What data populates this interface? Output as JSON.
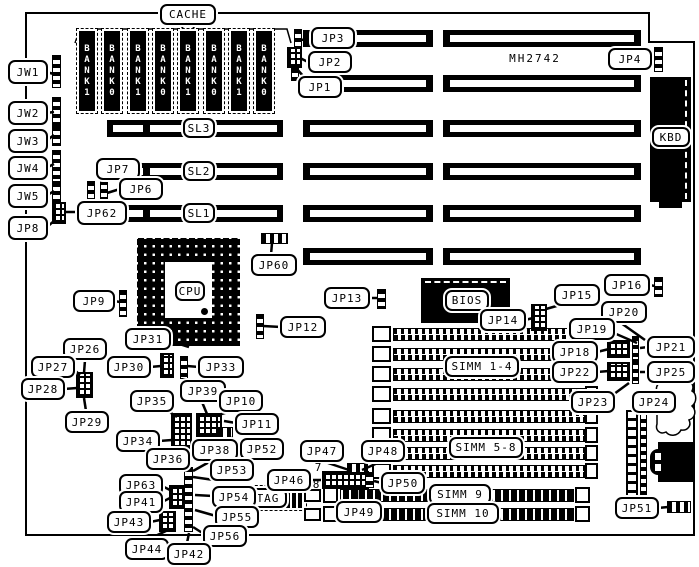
{
  "part_number": "MH2742",
  "cache_banks": [
    "BANK1",
    "BANK0",
    "BANK1",
    "BANK0",
    "BANK1",
    "BANK0",
    "BANK1",
    "BANK0"
  ],
  "labels_text": {
    "cache": "CACHE",
    "jw1": "JW1",
    "jw2": "JW2",
    "jw3": "JW3",
    "jw4": "JW4",
    "jw5": "JW5",
    "jp8": "JP8",
    "jp3": "JP3",
    "jp2": "JP2",
    "jp1": "JP1",
    "jp4": "JP4",
    "kbd": "KBD",
    "cpu": "CPU",
    "bios": "BIOS",
    "tag": "TAG",
    "sl3": "SL3",
    "sl2": "SL2",
    "sl1": "SL1",
    "jp7": "JP7",
    "jp6": "JP6",
    "jp62": "JP62",
    "jp60": "JP60",
    "jp9": "JP9",
    "jp31": "JP31",
    "jp12": "JP12",
    "jp13": "JP13",
    "jp14": "JP14",
    "jp15": "JP15",
    "jp16": "JP16",
    "jp19": "JP19",
    "jp20": "JP20",
    "jp18": "JP18",
    "jp21": "JP21",
    "jp22": "JP22",
    "jp25": "JP25",
    "jp23": "JP23",
    "jp24": "JP24",
    "simm14": "SIMM 1-4",
    "simm58": "SIMM 5-8",
    "simm9": "SIMM 9",
    "simm10": "SIMM 10",
    "jp26": "JP26",
    "jp27": "JP27",
    "jp28": "JP28",
    "jp29": "JP29",
    "jp30": "JP30",
    "jp33": "JP33",
    "jp35": "JP35",
    "jp39": "JP39",
    "jp10": "JP10",
    "jp11": "JP11",
    "jp34": "JP34",
    "jp36": "JP36",
    "jp38": "JP38",
    "jp52": "JP52",
    "jp53": "JP53",
    "jp63": "JP63",
    "jp41": "JP41",
    "jp54": "JP54",
    "jp55": "JP55",
    "jp43": "JP43",
    "jp56": "JP56",
    "jp44": "JP44",
    "jp42": "JP42",
    "jp46": "JP46",
    "jp47": "JP47",
    "jp48": "JP48",
    "jp50": "JP50",
    "jp49": "JP49",
    "jp51": "JP51",
    "pin7": "7",
    "pin8": "8"
  }
}
